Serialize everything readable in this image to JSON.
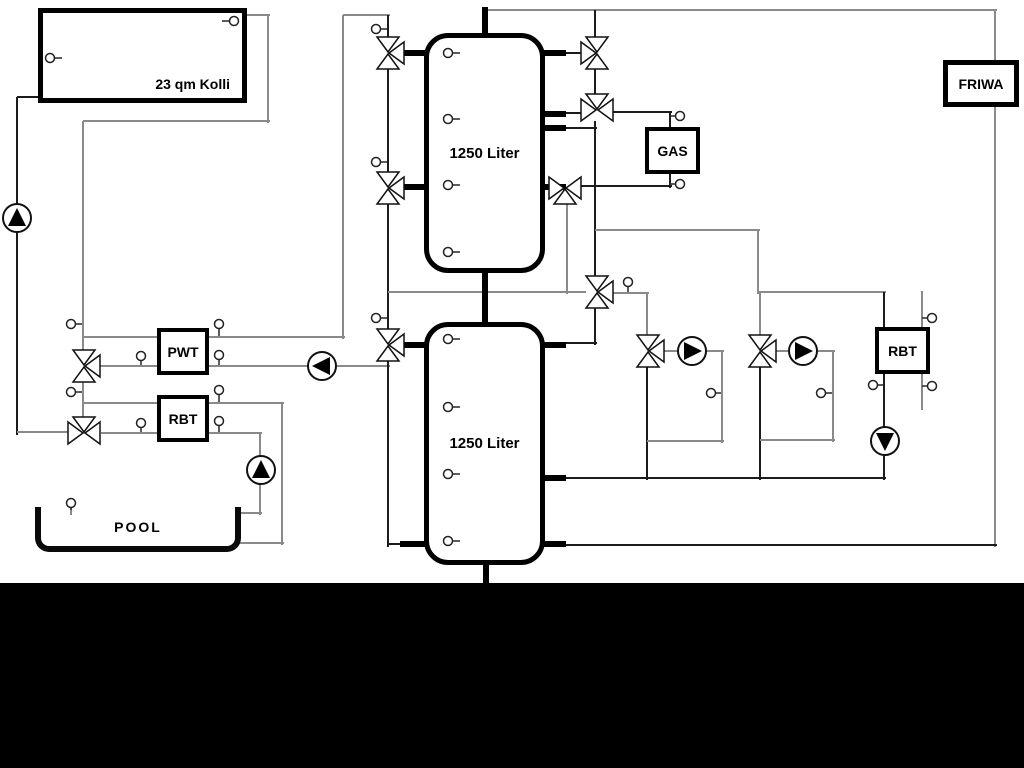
{
  "diagram": {
    "collector": {
      "label": "23 qm Kolli"
    },
    "tank_top": {
      "label": "1250 Liter"
    },
    "tank_bottom": {
      "label": "1250 Liter"
    },
    "gas": {
      "label": "GAS"
    },
    "friwa": {
      "label": "FRIWA"
    },
    "pwt": {
      "label": "PWT"
    },
    "rbt_left": {
      "label": "RBT"
    },
    "rbt_right": {
      "label": "RBT"
    },
    "pool": {
      "label": "POOL"
    },
    "colors": {
      "pipe_gray": "#8a8a8a",
      "pipe_dark": "#1c1c1c",
      "outline": "#000000"
    }
  }
}
